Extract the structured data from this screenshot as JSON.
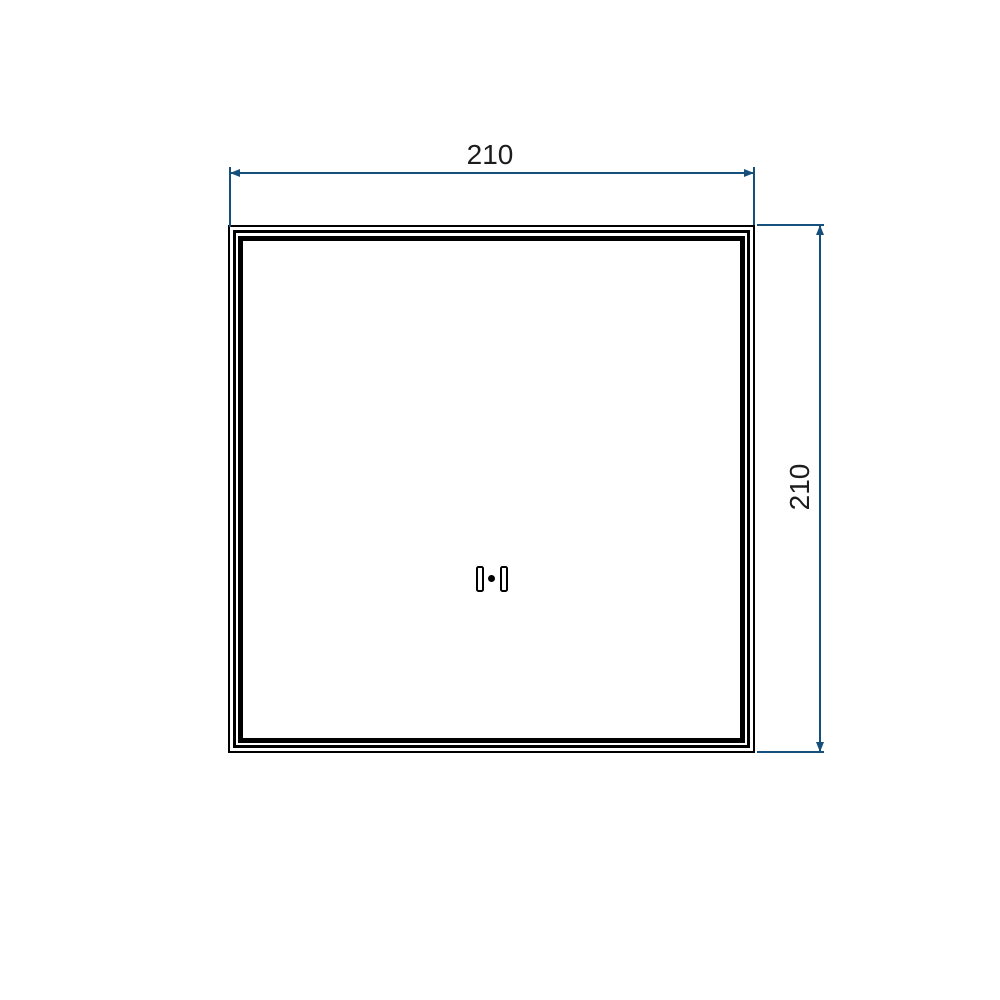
{
  "drawing": {
    "type": "technical-drawing",
    "panel": {
      "shape": "square",
      "frame_outline_count": 3
    },
    "dimensions": [
      {
        "id": "width-top",
        "label": "210",
        "value": 210,
        "orientation": "horizontal",
        "position": "top"
      },
      {
        "id": "height-right",
        "label": "210",
        "value": 210,
        "orientation": "vertical",
        "position": "right"
      }
    ],
    "center_detail": {
      "name": "handle-detail",
      "parts": [
        "left-bracket",
        "center-dot",
        "right-bracket"
      ]
    },
    "colors": {
      "background": "#ffffff",
      "outline": "#000000",
      "dimension_line": "#15507d",
      "dimension_text": "#1c1c1c"
    }
  }
}
